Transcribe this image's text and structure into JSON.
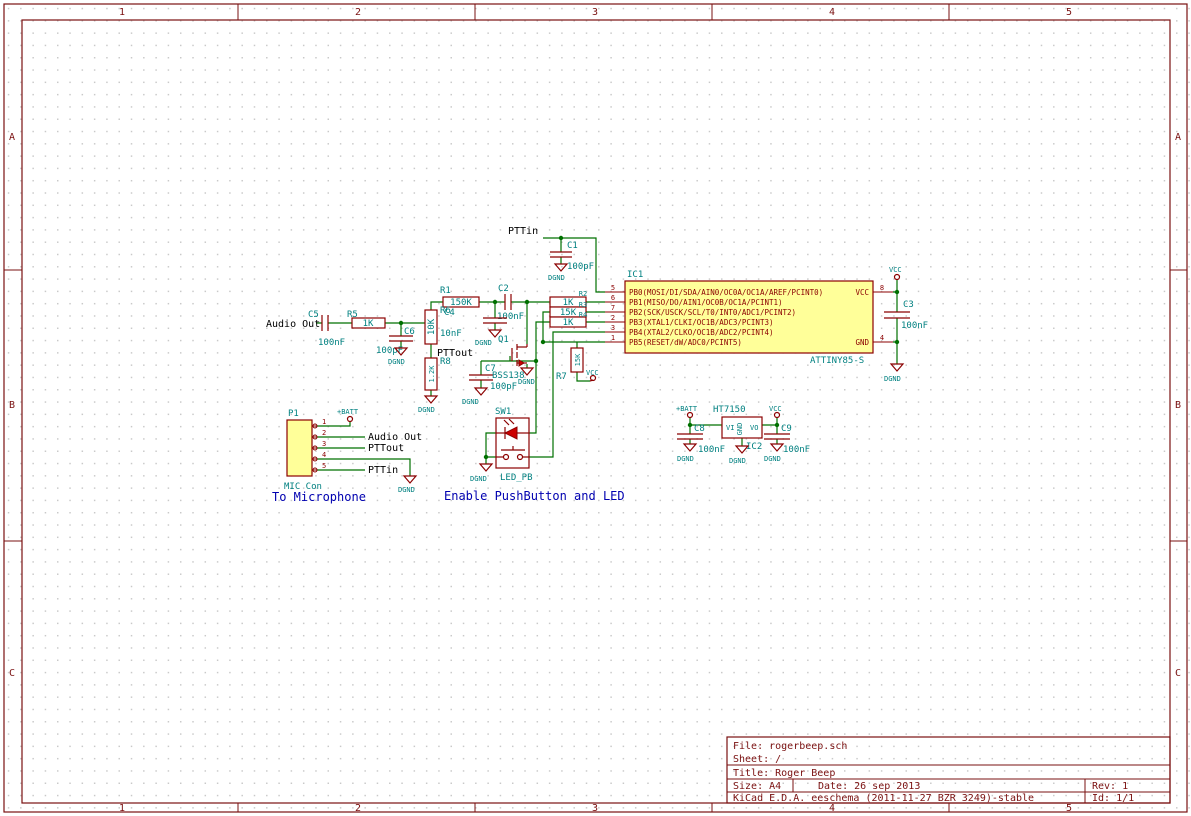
{
  "app": {
    "name": "KiCad eeschema schematic sheet"
  },
  "sheet": {
    "cols": [
      "1",
      "2",
      "3",
      "4",
      "5"
    ],
    "rows": [
      "A",
      "B",
      "C"
    ]
  },
  "title_block": {
    "file": "File: rogerbeep.sch",
    "sheet": "Sheet: /",
    "title": "Title: Roger Beep",
    "size": "Size: A4",
    "date": "Date: 26 sep 2013",
    "rev": "Rev: 1",
    "tool": "KiCad E.D.A.  eeschema (2011-11-27 BZR 3249)-stable",
    "id": "Id: 1/1"
  },
  "ic1": {
    "ref": "IC1",
    "value": "ATTINY85-S",
    "pins_left": [
      {
        "num": "5",
        "name": "PB0(MOSI/DI/SDA/AIN0/OC0A/OC1A/AREF/PCINT0)"
      },
      {
        "num": "6",
        "name": "PB1(MISO/DO/AIN1/OC0B/OC1A/PCINT1)"
      },
      {
        "num": "7",
        "name": "PB2(SCK/USCK/SCL/T0/INT0/ADC1/PCINT2)"
      },
      {
        "num": "2",
        "name": "PB3(XTAL1/CLKI/OC1B/ADC3/PCINT3)"
      },
      {
        "num": "3",
        "name": "PB4(XTAL2/CLKO/OC1B/ADC2/PCINT4)"
      },
      {
        "num": "1",
        "name": "PB5(RESET/dW/ADC0/PCINT5)"
      }
    ],
    "pins_right": [
      {
        "num": "8",
        "name": "VCC"
      },
      {
        "num": "4",
        "name": "GND"
      }
    ]
  },
  "ic2": {
    "ref": "IC2",
    "value": "HT7150",
    "pin_vi": "VI",
    "pin_gnd": "GND",
    "pin_vo": "VO"
  },
  "connector": {
    "ref": "P1",
    "value": "MIC Con",
    "pins": [
      "1",
      "2",
      "3",
      "4",
      "5"
    ]
  },
  "transistor": {
    "ref": "Q1",
    "value": "BSS138"
  },
  "switch": {
    "ref": "SW1",
    "value": "LED_PB"
  },
  "resistors": {
    "r1": {
      "ref": "R1",
      "value": "150K"
    },
    "r2": {
      "ref": "R2",
      "value": "1K"
    },
    "r3": {
      "ref": "R3",
      "value": "15K"
    },
    "r4": {
      "ref": "R4",
      "value": "1K"
    },
    "r5": {
      "ref": "R5",
      "value": "1K"
    },
    "r6": {
      "ref": "R6",
      "value": "10K"
    },
    "r7": {
      "ref": "R7",
      "value": "15K"
    },
    "r8": {
      "ref": "R8",
      "value": "1.2K"
    }
  },
  "capacitors": {
    "c1": {
      "ref": "C1",
      "value": "100pF"
    },
    "c2": {
      "ref": "C2",
      "value": "100nF"
    },
    "c3": {
      "ref": "C3",
      "value": "100nF"
    },
    "c4": {
      "ref": "C4",
      "value": "10nF"
    },
    "c5": {
      "ref": "C5",
      "value": "100nF"
    },
    "c6": {
      "ref": "C6",
      "value": "100pF"
    },
    "c7": {
      "ref": "C7",
      "value": "100pF"
    },
    "c8": {
      "ref": "C8",
      "value": "100nF"
    },
    "c9": {
      "ref": "C9",
      "value": "100nF"
    }
  },
  "net_labels": {
    "audio_out": "Audio Out",
    "pttout": "PTTout",
    "pttin": "PTTin"
  },
  "power": {
    "vcc": "VCC",
    "dgnd": "DGND",
    "batt": "+BATT"
  },
  "notes": {
    "microphone": "To Microphone",
    "enable": "Enable PushButton and LED"
  },
  "colors": {
    "wire": "#007000",
    "component": "#8b0000",
    "field": "#008080",
    "net_label": "#000000",
    "note": "#0000b0",
    "frame": "#7a1010",
    "ic_fill": "#ffff99",
    "led": "#cc0000"
  }
}
